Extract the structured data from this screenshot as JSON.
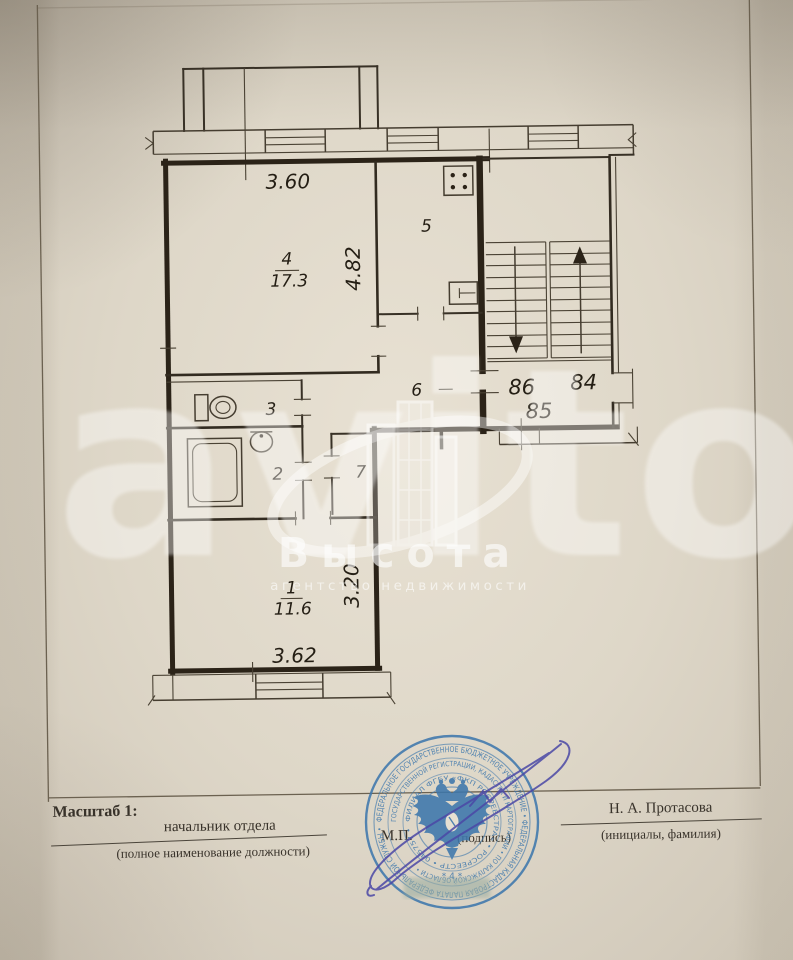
{
  "plan": {
    "dim_top": "3.60",
    "dim_left": "4.82",
    "dim_right": "3.20",
    "dim_bottom": "3.62",
    "room4_num": "4",
    "room4_area": "17.3",
    "room5": "5",
    "room6": "6",
    "room3": "3",
    "room2": "2",
    "room7": "7",
    "room1_num": "1",
    "room1_area": "11.6",
    "apt_left": "86",
    "apt_right": "84",
    "apt_center": "85"
  },
  "footer": {
    "scale_label": "Масштаб 1:",
    "position_title": "начальник отдела",
    "position_hint": "(полное наименование должности)",
    "stamp_mark": "М.П.",
    "signature_hint": "(подпись)",
    "name": "Н. А. Протасова",
    "name_hint": "(инициалы, фамилия)"
  },
  "watermark": {
    "site": "avito",
    "brand": "Высота",
    "brand_sub": "агентство недвижимости"
  },
  "stamp": {
    "ring1": "ФЕДЕРАЛЬНОЕ ГОСУДАРСТВЕННОЕ БЮДЖЕТНОЕ УЧРЕЖДЕНИЕ • ФЕДЕРАЛЬНАЯ КАДАСТРОВАЯ ПАЛАТА ФЕДЕРАЛЬНОЙ СЛУЖБЫ •",
    "ring2": "ГОСУДАРСТВЕННОЙ РЕГИСТРАЦИИ, КАДАСТРА И КАРТОГРАФИИ • ПО КАЛУЖСКОЙ ОБЛАСТИ •",
    "ring3": "ФИЛИАЛ ФГБУ «ФКП РОСРЕЕСТРА» • РОСРЕЕСТР • 045757 •",
    "center_num": "* 4 *"
  },
  "colors": {
    "paper": "#ddd6c7",
    "ink": "#2b2318",
    "stamp_blue": "#3f78ad",
    "signature_violet": "#4b48a6",
    "watermark_white": "#ffffff"
  }
}
